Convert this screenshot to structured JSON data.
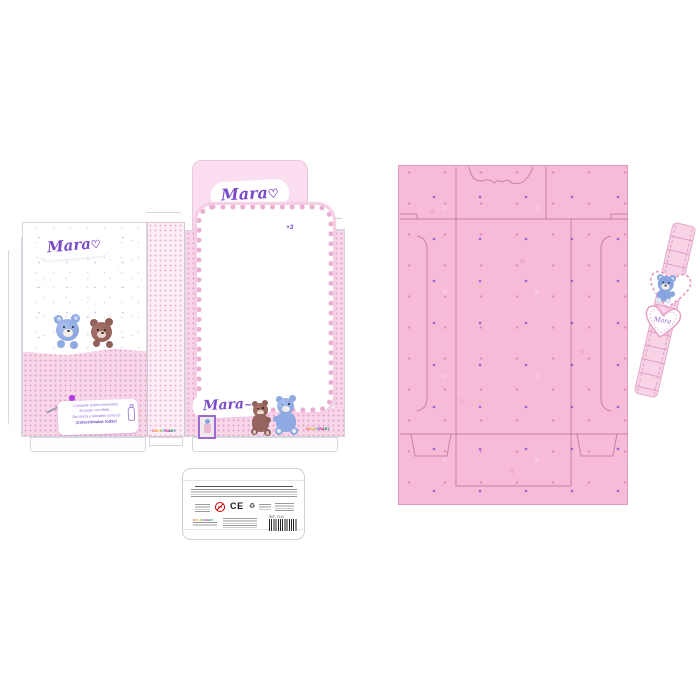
{
  "colors": {
    "accent_purple": "#7b4cc8",
    "pink_panel": "#f7bad7",
    "pink_band": "#f8d7e9",
    "header_pink": "#fbdff0",
    "blue_bear": "#8fa9e2",
    "brown_bear": "#96655f"
  },
  "brand": {
    "logo_text": "Mara",
    "logo_heart": "♡",
    "logo_flourish": "~",
    "maker": "COLORBABY",
    "maker_palette": [
      "#e6332a",
      "#f39200",
      "#e6b800",
      "#95c11f",
      "#36a9e1",
      "#e6007e",
      "#662483",
      "#009640",
      "#1d71b8"
    ]
  },
  "front_panel": {
    "message_line1": "Comparte dulces momentos",
    "message_line2": "de juego con Mara...",
    "message_line3": "¡Tan única y adorable como tú!",
    "message_line4": "¡Colecciónalas todas!"
  },
  "window_panel": {
    "age_mark": "+3"
  },
  "tag": {
    "heart_text": "Mara"
  },
  "label": {
    "ce_mark": "CE",
    "age_warning": "0-3",
    "ref": "REF. 2140",
    "recycle": "♻"
  },
  "decor": {
    "heart": "♥",
    "star": "☆",
    "plus": "+"
  }
}
